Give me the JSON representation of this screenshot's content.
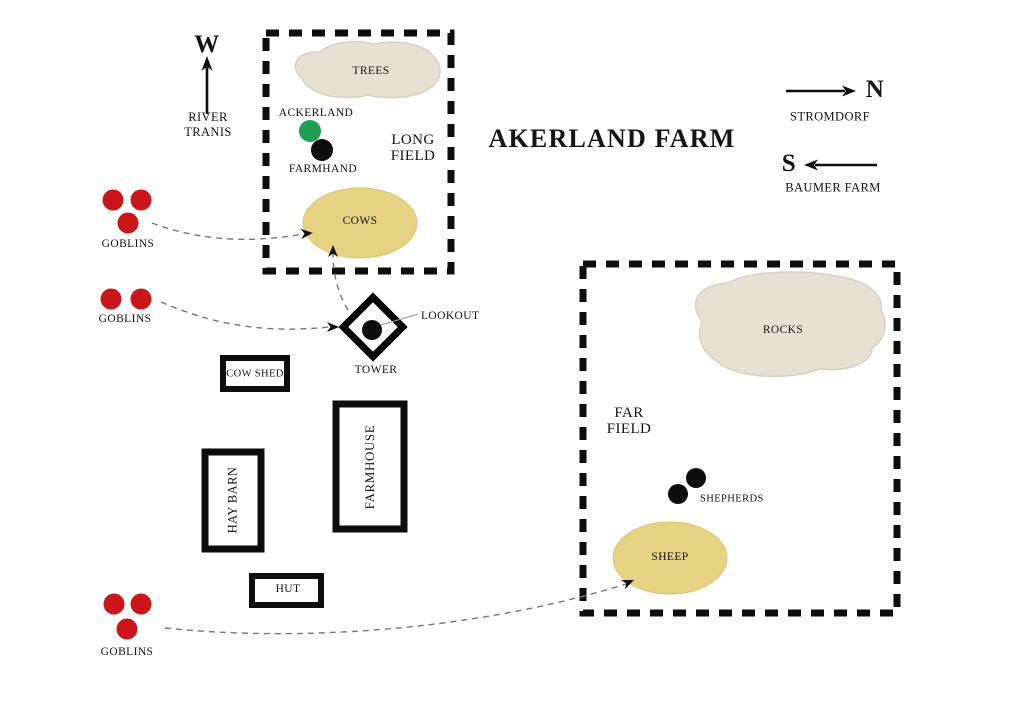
{
  "title": "AKERLAND FARM",
  "colors": {
    "goblin_red": "#cc1518",
    "ackerland_green": "#1f9e55",
    "herd_yellow": "#e5d283",
    "terrain_beige": "#e7e1d3",
    "ink_black": "#0d0d0d",
    "route_gray": "#777777"
  },
  "compass": {
    "west": {
      "letter": "W",
      "line1": "RIVER",
      "line2": "TRANIS"
    },
    "north": {
      "letter": "N",
      "label": "STROMDORF"
    },
    "south": {
      "letter": "S",
      "label": "BAUMER FARM"
    }
  },
  "fields": {
    "long_field": {
      "line1": "LONG",
      "line2": "FIELD"
    },
    "far_field": {
      "line1": "FAR",
      "line2": "FIELD"
    }
  },
  "terrain": {
    "trees": "TREES",
    "rocks": "ROCKS"
  },
  "herds": {
    "cows": "COWS",
    "sheep": "SHEEP"
  },
  "buildings": {
    "cow_shed": "COW SHED",
    "farmhouse": "FARMHOUSE",
    "hay_barn": "HAY BARN",
    "hut": "HUT",
    "tower": "TOWER",
    "lookout": "LOOKOUT"
  },
  "units": {
    "ackerland": "ACKERLAND",
    "farmhand": "FARMHAND",
    "shepherds": "SHEPHERDS",
    "goblins_north": "GOBLINS",
    "goblins_middle": "GOBLINS",
    "goblins_south": "GOBLINS"
  }
}
